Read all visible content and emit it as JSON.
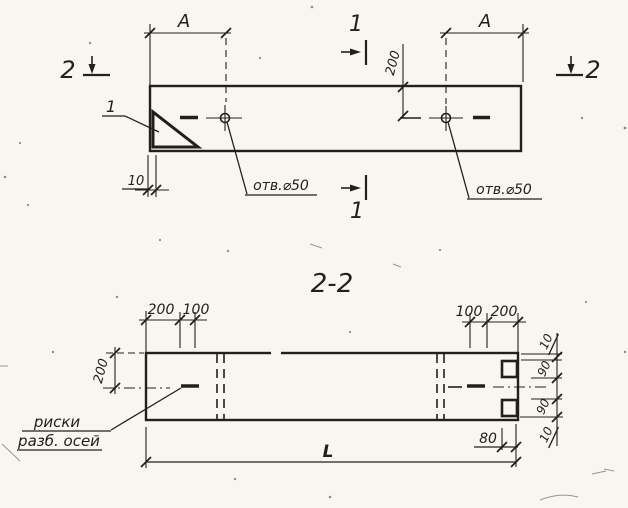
{
  "colors": {
    "ink": "#21201c",
    "paper": "#f7f6f1"
  },
  "top_view": {
    "section_label_2_left": "2",
    "section_label_2_right": "2",
    "section_label_1_top": "1",
    "section_label_1_bottom": "1",
    "dim_a_left": "A",
    "dim_a_right": "A",
    "dim_offset_200": "200",
    "dim_edge_10": "10",
    "callout_detail_1": "1",
    "hole_label_left": "отв.⌀50",
    "hole_label_right": "отв.⌀50"
  },
  "section_view": {
    "title": "2-2",
    "top_left_dims": [
      "200",
      "100"
    ],
    "top_right_dims": [
      "100",
      "200"
    ],
    "dim_height_200": "200",
    "right_chain_dims": [
      "10",
      "90",
      "90",
      "10"
    ],
    "dim_80": "80",
    "dim_length": "L",
    "axis_marks_note": [
      "риски",
      "разб. осей"
    ]
  }
}
